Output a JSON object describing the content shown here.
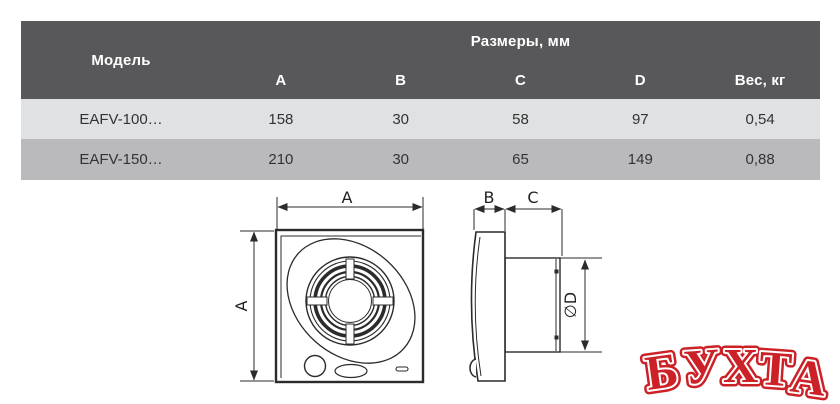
{
  "table": {
    "header": {
      "model": "Модель",
      "sizes_group": "Размеры, мм",
      "columns": [
        "A",
        "B",
        "C",
        "D",
        "Вес, кг"
      ]
    },
    "rows": [
      {
        "model": "EAFV-100…",
        "a": "158",
        "b": "30",
        "c": "58",
        "d": "97",
        "weight": "0,54"
      },
      {
        "model": "EAFV-150…",
        "a": "210",
        "b": "30",
        "c": "65",
        "d": "149",
        "weight": "0,88"
      }
    ]
  },
  "drawing": {
    "labels": {
      "front_width": "A",
      "front_height": "A",
      "panel_depth": "B",
      "duct_depth": "C",
      "duct_diameter": "∅D"
    }
  },
  "watermark": {
    "text": "БУХТА",
    "color": "#cc2127"
  },
  "colors": {
    "header_bg": "#58585a",
    "row_light": "#e0e1e2",
    "row_dark": "#bababc",
    "line": "#2c2a2b",
    "header_text": "#ffffff",
    "body_text": "#333333",
    "watermark_red": "#cc2127"
  }
}
